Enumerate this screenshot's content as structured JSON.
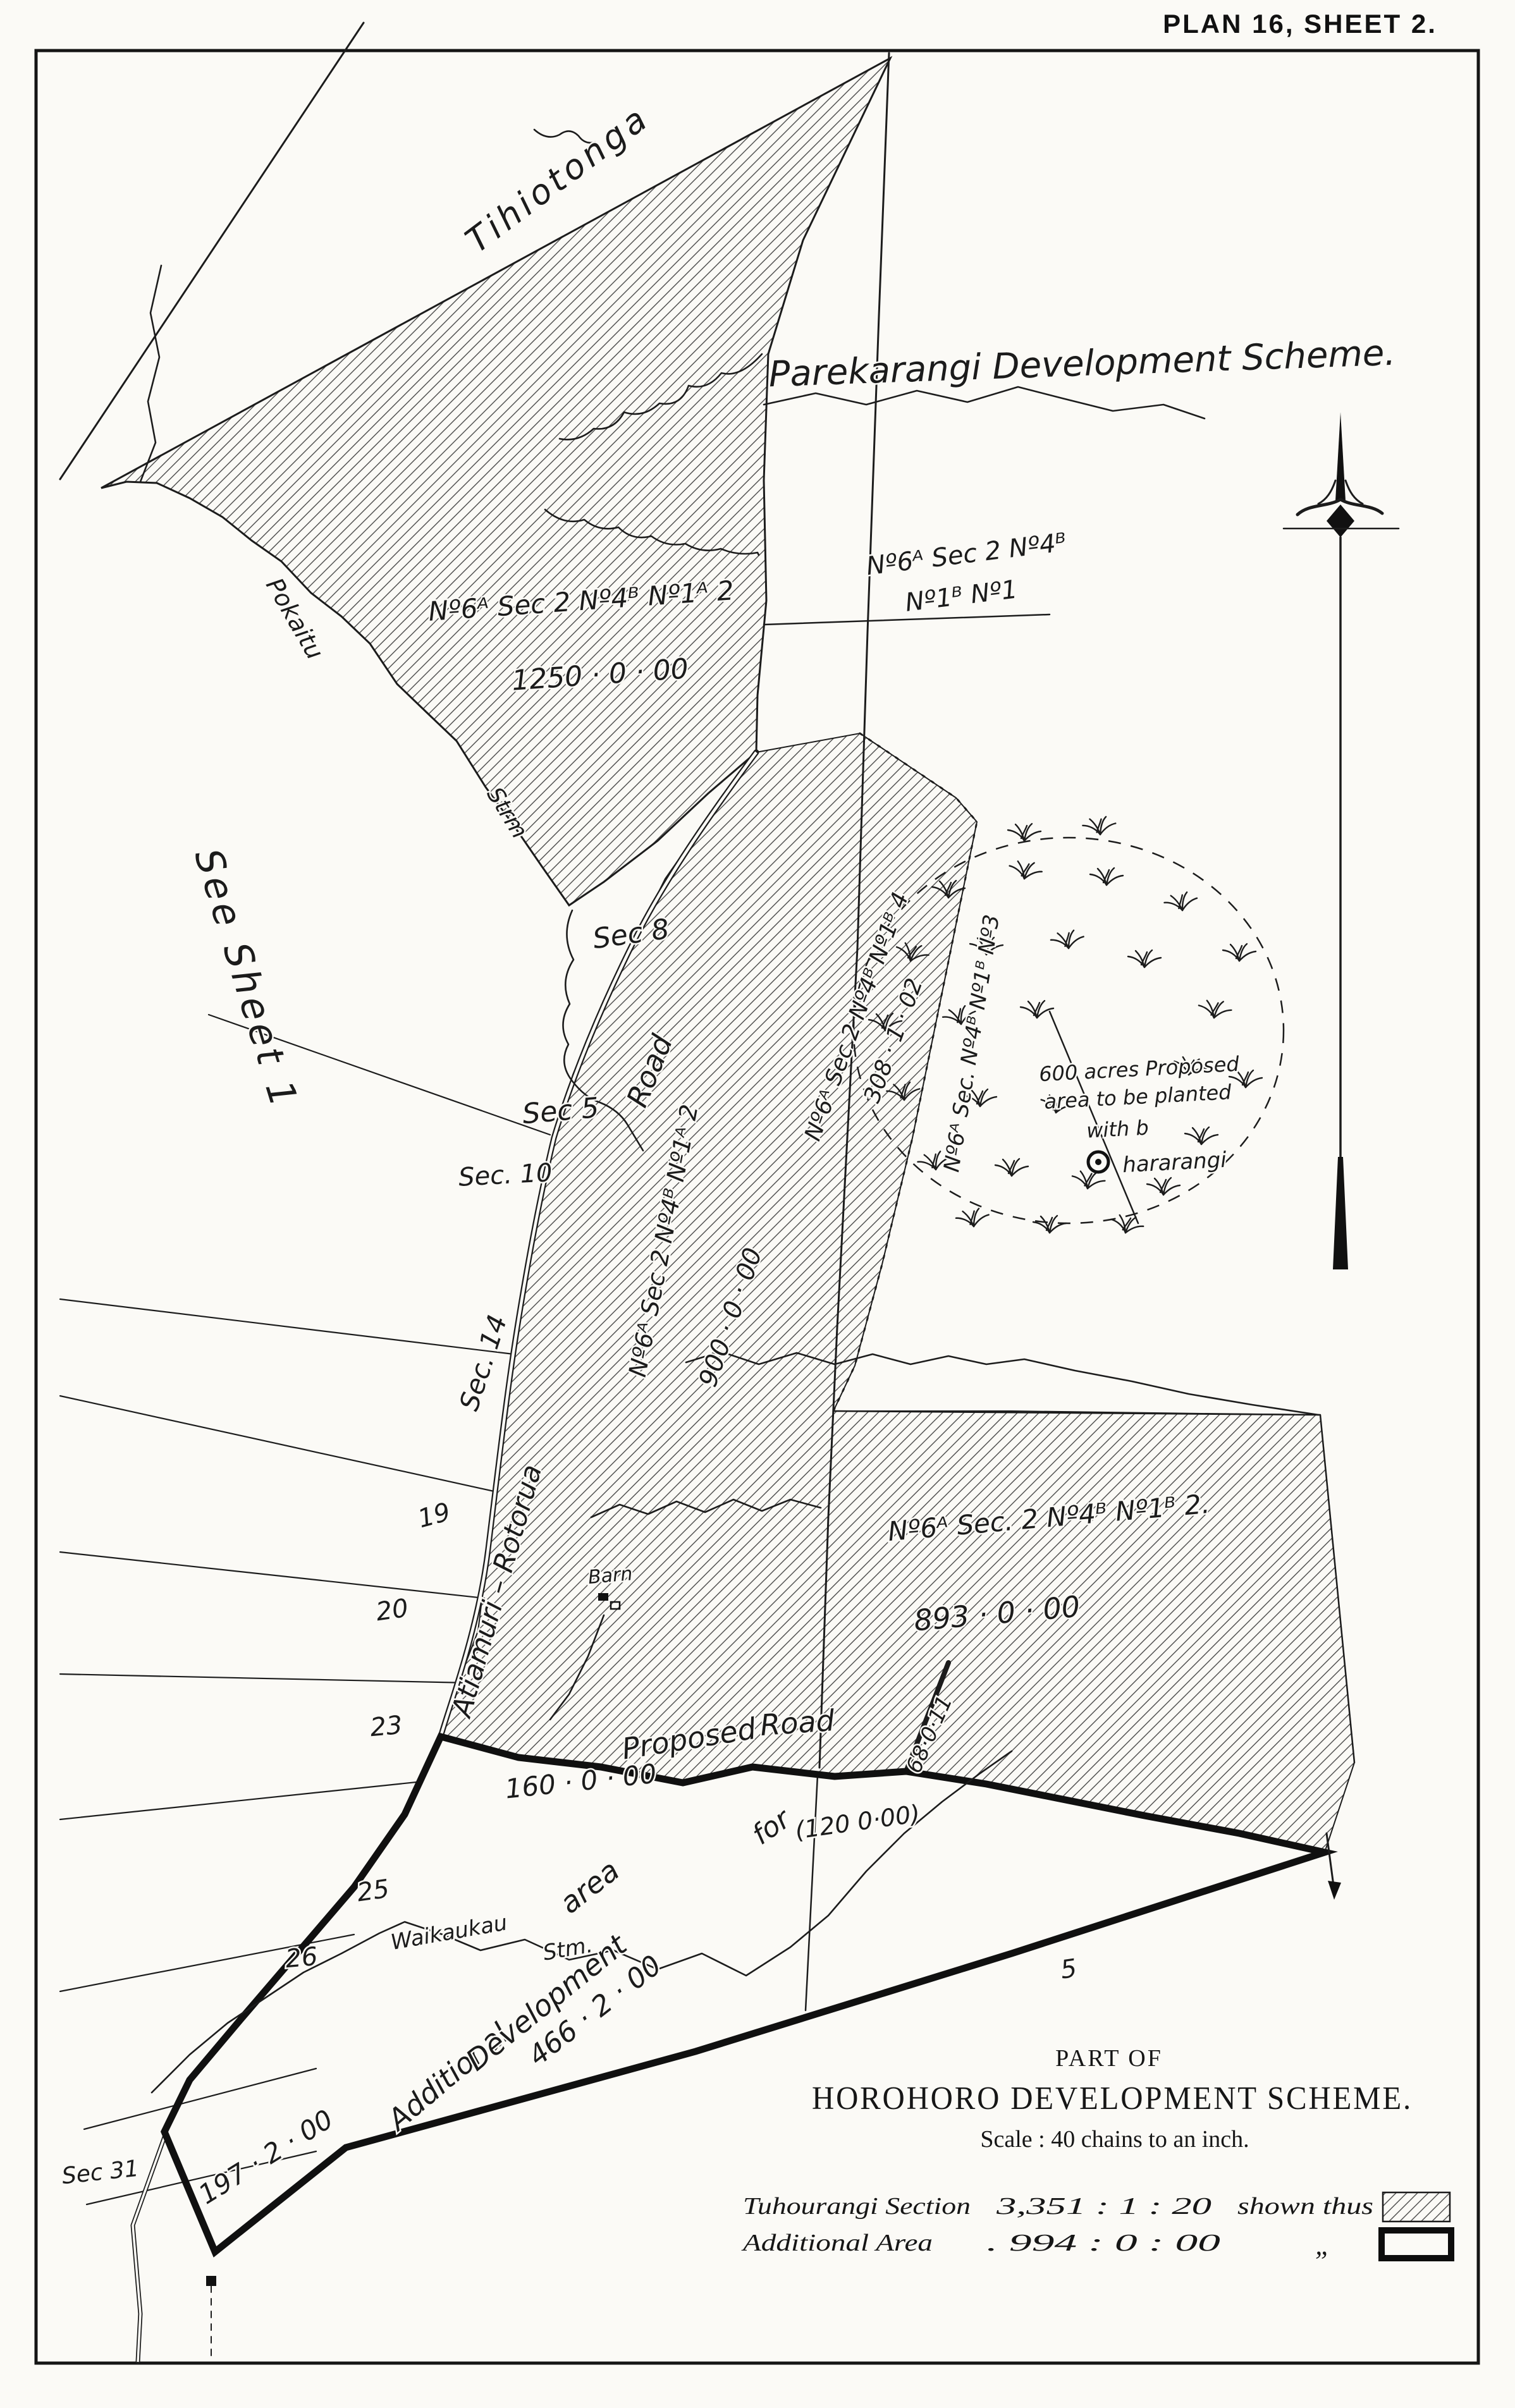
{
  "page": {
    "plan_title": "PLAN 16, SHEET 2."
  },
  "map": {
    "region_titles": {
      "tihiotonga": "Tihiotonga",
      "parekarangi": "Parekarangi Development Scheme.",
      "see_sheet": "See Sheet 1"
    },
    "parcels": {
      "p1250": {
        "name": "Nº6ᴬ Sec 2 Nº4ᴮ Nº1ᴬ 2",
        "area": "1250 · 0 · 00"
      },
      "ne": {
        "name_line1": "Nº6ᴬ Sec 2 Nº4ᴮ",
        "name_line2": "Nº1ᴮ Nº1"
      },
      "p308": {
        "name": "Nº6ᴬ Sec 2 Nº4ᴮ Nº1ᴮ 4",
        "area": "308 · 1 · 02"
      },
      "p900": {
        "name": "Nº6ᴬ Sec 2 Nº4ᴮ Nº1ᴬ 2",
        "area": "900 · 0 · 00"
      },
      "p893": {
        "name": "Nº6ᴬ Sec. 2 Nº4ᴮ Nº1ᴮ 2.",
        "area": "893 · 0 · 00"
      },
      "planted": {
        "name": "Nº6ᴬ Sec. Nº4ᴮ Nº1ᴮ Nº3",
        "note_line1": "600 acres Proposed",
        "note_line2": "area to be planted",
        "note_line3": "with b",
        "trig_name": "hararangi"
      },
      "p68": {
        "area": "68·0·11"
      },
      "p160": {
        "area": "160 · 0 · 00"
      },
      "p120": {
        "area": "(120 0·00)"
      },
      "p466": {
        "area": "466 · 2 · 00"
      },
      "p197": {
        "area": "197 · 2 · 00"
      }
    },
    "sections": {
      "sec8": "Sec 8",
      "sec5": "Sec 5",
      "sec10": "Sec. 10",
      "sec14": "Sec. 14",
      "sec31": "Sec 31"
    },
    "lot_numbers": {
      "n19": "19",
      "n20": "20",
      "n23": "23",
      "n25": "25",
      "n26": "26",
      "n5": "5"
    },
    "roads": {
      "atiamuri": "Atiamuri – Rotorua",
      "road_word": "Road",
      "proposed": "Proposed",
      "proposed_word": "Road"
    },
    "streams": {
      "pokaitu": "Pokaitu",
      "pokaitu_strm": "Strm",
      "waikaukau": "Waikaukau",
      "waikaukau_stm": "Stm."
    },
    "features": {
      "barn": "Barn"
    },
    "additional_phrase": {
      "w1": "Additional",
      "w2": "area",
      "w3": "for",
      "w4": "Development"
    }
  },
  "title_block": {
    "part_of": "PART OF",
    "scheme": "HOROHORO DEVELOPMENT SCHEME.",
    "scale": "Scale :  40 chains to an inch."
  },
  "legend": {
    "rows": [
      {
        "name": "Tuhourangi Section",
        "figures": "3,351  :  1  :  20",
        "suffix": "shown thus",
        "swatch": "hatched"
      },
      {
        "name": "Additional Area",
        "figures": ".    994  :  0  :  00",
        "suffix": "„",
        "swatch": "bold-outline"
      }
    ]
  },
  "colors": {
    "ink": "#1c1c1c",
    "paper": "#fbfaf6"
  }
}
